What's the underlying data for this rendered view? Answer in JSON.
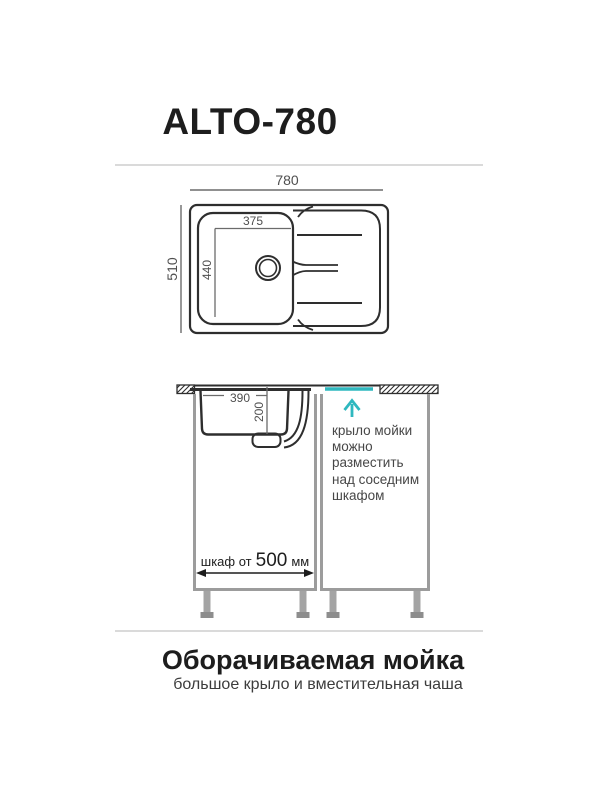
{
  "colors": {
    "line_dark": "#2e2e2e",
    "dim_gray": "#6b6b6b",
    "cabinet_gray": "#9c9c9c",
    "leg_gray": "#a4a4a4",
    "foot_gray": "#8d8d8d",
    "accent_teal": "#2fb8bf",
    "divider_gray": "#dadada"
  },
  "header": {
    "model": "ALTO-780"
  },
  "top_view": {
    "overall_width_mm": "780",
    "overall_depth_mm": "510",
    "bowl_width_mm": "375",
    "bowl_depth_mm": "440"
  },
  "section_view": {
    "bowl_width_mm": "390",
    "bowl_depth_mm": "200",
    "cabinet_dim_prefix": "шкаф от",
    "cabinet_dim_value": "500",
    "cabinet_dim_unit": "мм",
    "note_lines": [
      "крыло мойки",
      "можно",
      "разместить",
      "над соседним",
      "шкафом"
    ]
  },
  "footer": {
    "title": "Оборачиваемая мойка",
    "subtitle": "большое крыло и вместительная чаша"
  }
}
